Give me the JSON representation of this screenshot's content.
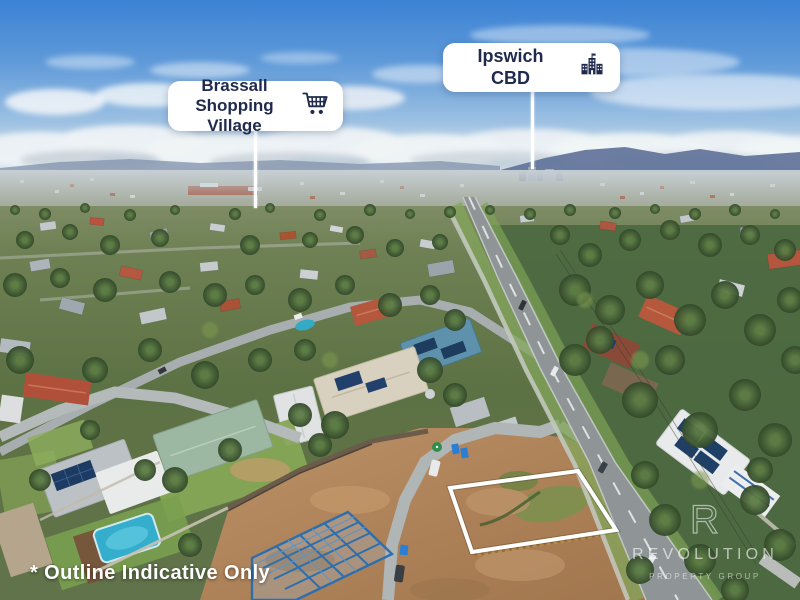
{
  "callouts": [
    {
      "id": "brassall",
      "line1": "Brassall",
      "line2": "Shopping Village",
      "icon": "shopping-cart-icon"
    },
    {
      "id": "ipswich",
      "line1": "Ipswich",
      "line2": "CBD",
      "icon": "city-buildings-icon"
    }
  ],
  "disclaimer": "* Outline Indicative Only",
  "watermark": {
    "logo_letter": "R",
    "name": "REVOLUTION",
    "tagline": "PROPERTY GROUP"
  },
  "colors": {
    "callout_bg": "#ffffff",
    "callout_text": "#1f2a4d",
    "property_outline": "#ffffff",
    "watermark_text": "rgba(255,255,255,0.6)",
    "sky_top": "#3b82d4",
    "road_asphalt": "#8f9596",
    "construction_dirt": "#b68a5f",
    "steel_frame_blue": "#2d6fae",
    "pool_blue": "#35aecd"
  }
}
